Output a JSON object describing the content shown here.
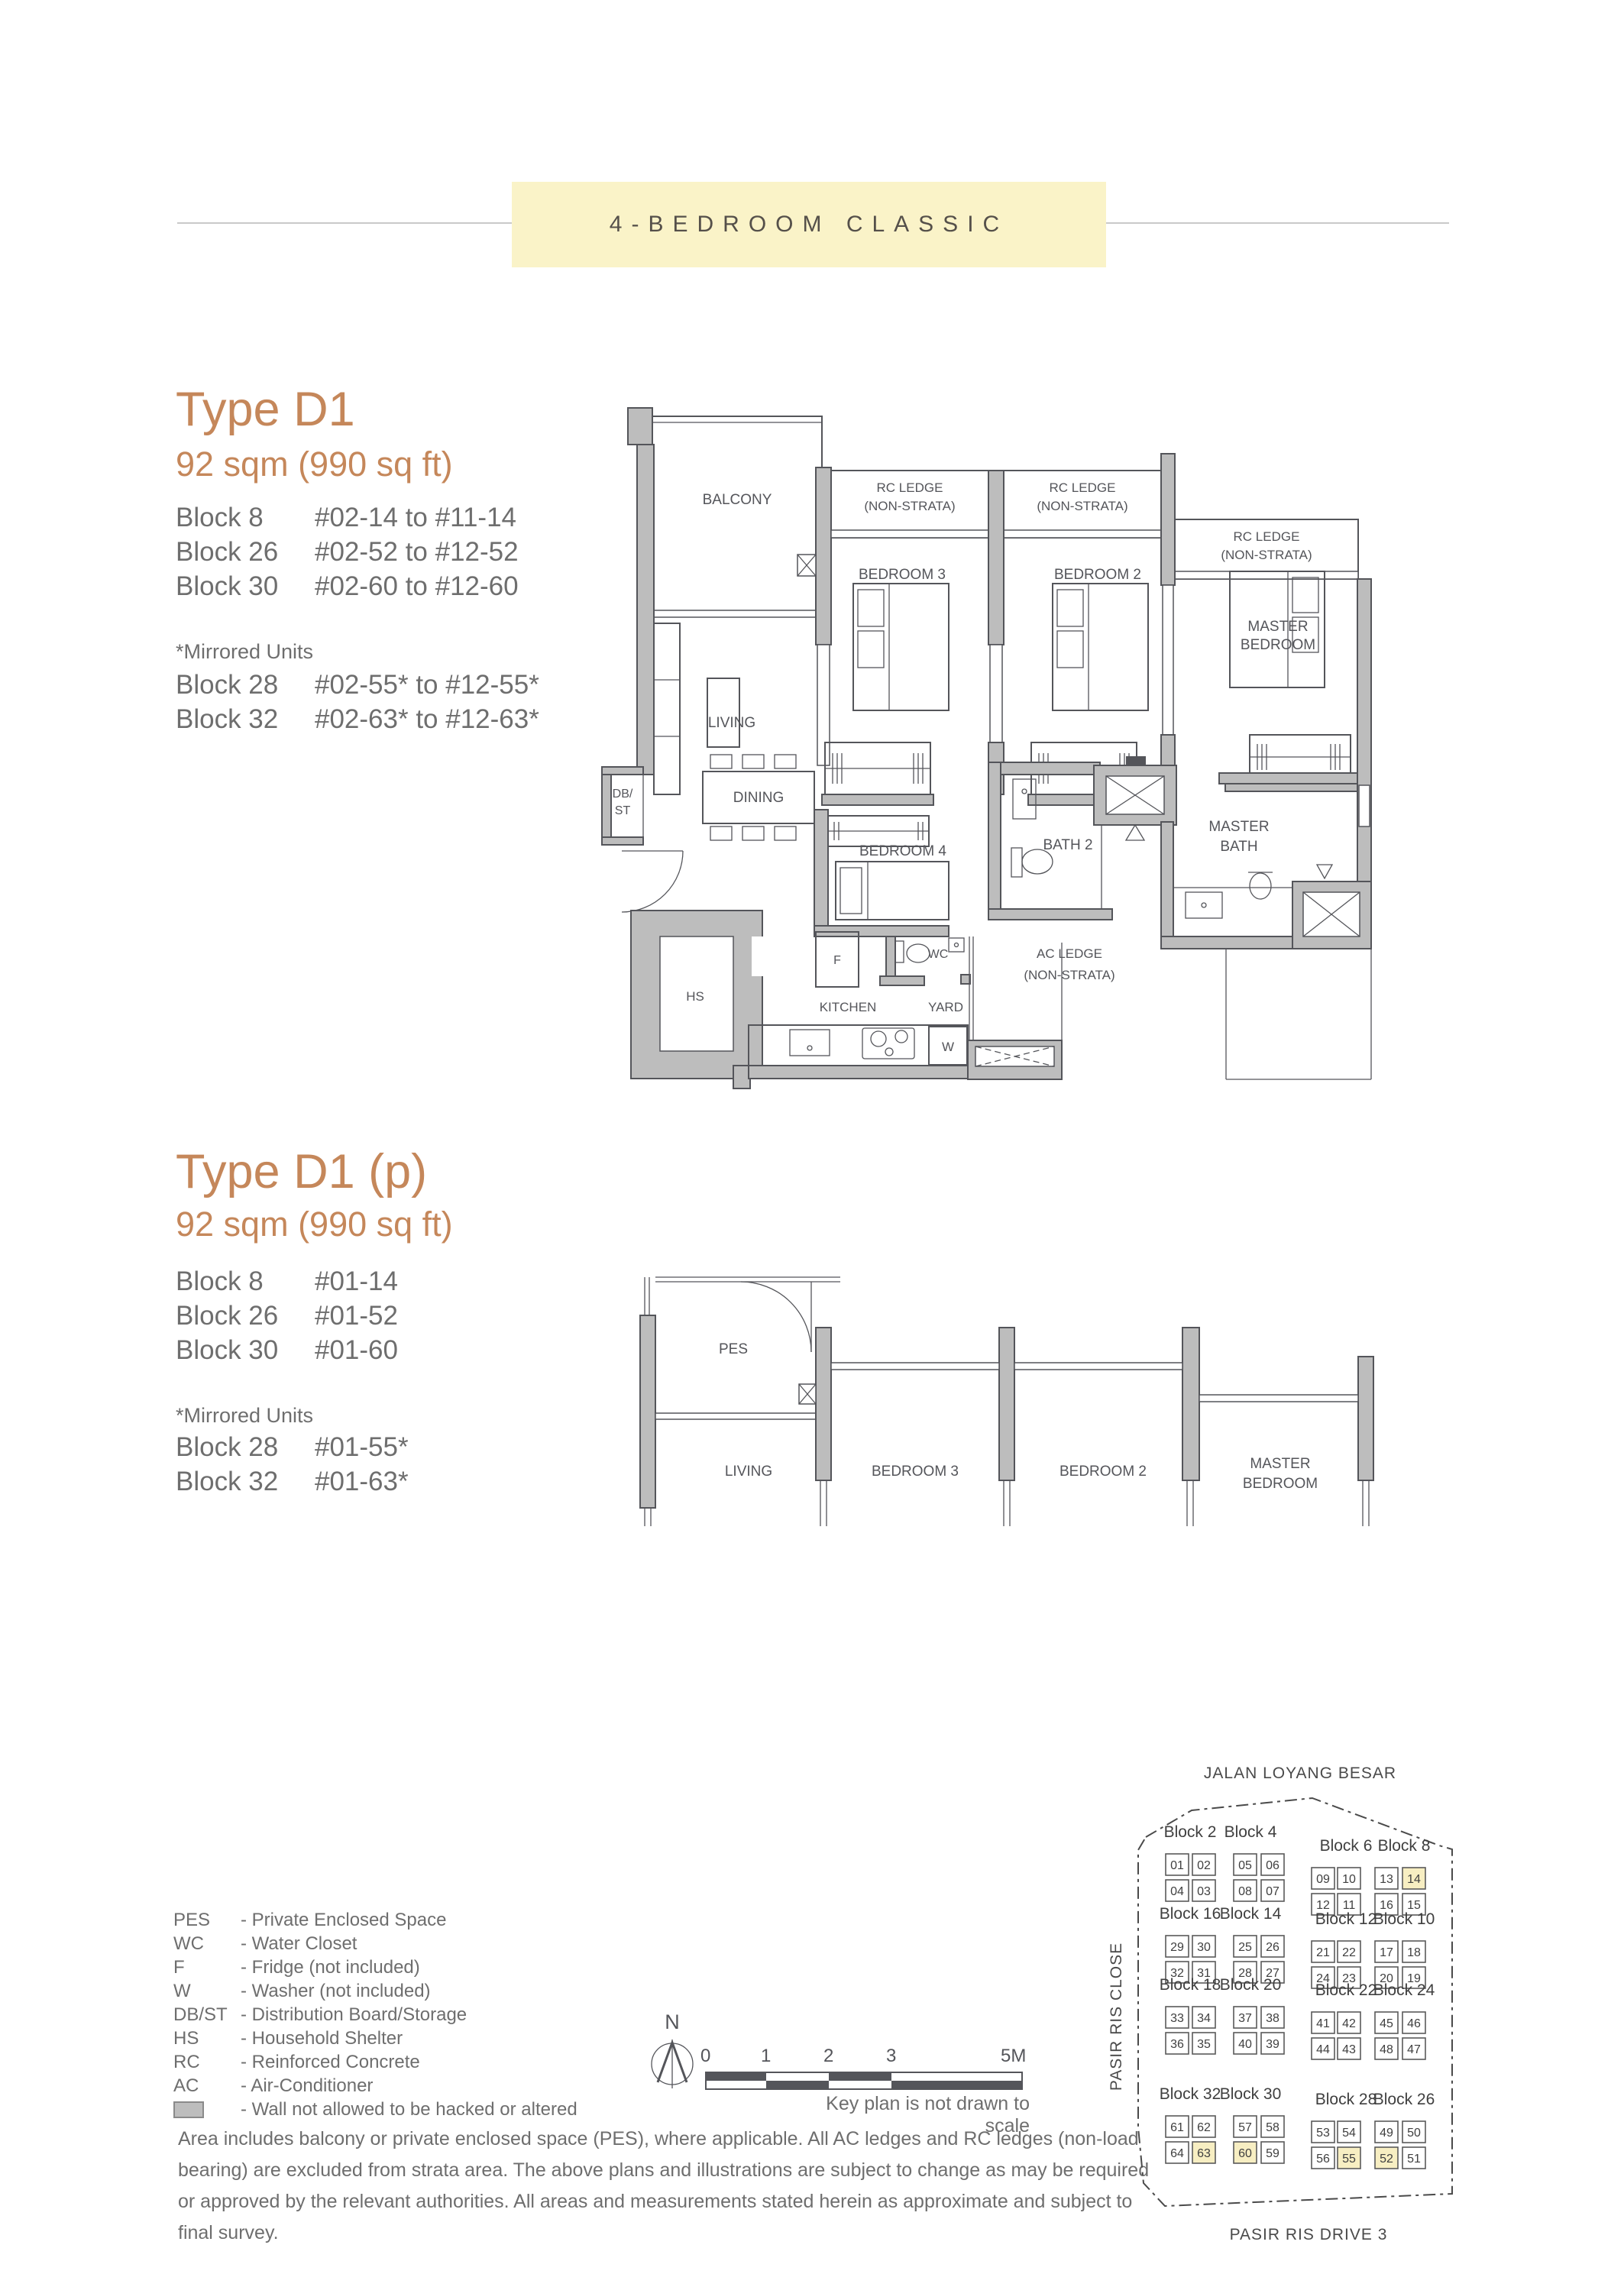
{
  "banner": {
    "label": "4-BEDROOM CLASSIC"
  },
  "type_d1": {
    "title": "Type D1",
    "area": "92 sqm (990 sq ft)",
    "blocks": [
      {
        "block": "Block 8",
        "units": "#02-14 to #11-14"
      },
      {
        "block": "Block 26",
        "units": "#02-52 to #12-52"
      },
      {
        "block": "Block 30",
        "units": "#02-60 to #12-60"
      }
    ],
    "mirrored_note": "*Mirrored Units",
    "mirrored_blocks": [
      {
        "block": "Block 28",
        "units": "#02-55* to #12-55*"
      },
      {
        "block": "Block 32",
        "units": "#02-63* to #12-63*"
      }
    ]
  },
  "type_d1p": {
    "title": "Type D1 (p)",
    "area": "92 sqm (990 sq ft)",
    "blocks": [
      {
        "block": "Block 8",
        "units": "#01-14"
      },
      {
        "block": "Block 26",
        "units": "#01-52"
      },
      {
        "block": "Block 30",
        "units": "#01-60"
      }
    ],
    "mirrored_note": "*Mirrored Units",
    "mirrored_blocks": [
      {
        "block": "Block 28",
        "units": "#01-55*"
      },
      {
        "block": "Block 32",
        "units": "#01-63*"
      }
    ]
  },
  "plan_labels": {
    "balcony": "BALCONY",
    "rc_ledge": "RC LEDGE",
    "non_strata": "(NON-STRATA)",
    "bedroom3": "BEDROOM 3",
    "bedroom2": "BEDROOM 2",
    "bedroom4": "BEDROOM 4",
    "master_line1": "MASTER",
    "master_line2": "BEDROOM",
    "master_bath_line2": "BATH",
    "living": "LIVING",
    "dining": "DINING",
    "bath2": "BATH 2",
    "ac_ledge": "AC LEDGE",
    "db_line1": "DB/",
    "db_line2": "ST",
    "fridge": "F",
    "wc": "WC",
    "hs": "HS",
    "kitchen": "KITCHEN",
    "yard": "YARD",
    "washer": "W",
    "pes": "PES"
  },
  "legend": {
    "items": [
      {
        "abbr": "PES",
        "desc": "- Private Enclosed Space"
      },
      {
        "abbr": "WC",
        "desc": "- Water Closet"
      },
      {
        "abbr": "F",
        "desc": "- Fridge (not included)"
      },
      {
        "abbr": "W",
        "desc": "- Washer (not included)"
      },
      {
        "abbr": "DB/ST",
        "desc": "- Distribution Board/Storage"
      },
      {
        "abbr": "HS",
        "desc": "- Household Shelter"
      },
      {
        "abbr": "RC",
        "desc": "- Reinforced Concrete"
      },
      {
        "abbr": "AC",
        "desc": "- Air-Conditioner"
      }
    ],
    "wall_swatch_desc": "- Wall not allowed to be hacked or altered"
  },
  "scalebar": {
    "north_label": "N",
    "ticks": [
      "0",
      "1",
      "2",
      "3",
      "5M"
    ],
    "note": "Key plan is not drawn to scale"
  },
  "disclaimer": {
    "text": "Area includes balcony or private enclosed space (PES), where applicable. All AC ledges and RC ledges (non-load bearing) are excluded from strata area. The above plans and illustrations are subject to change as may be required or approved by the relevant authorities. All areas and measurements stated herein as approximate and subject to final survey."
  },
  "keyplan": {
    "street_top": "JALAN LOYANG BESAR",
    "street_left": "PASIR RIS CLOSE",
    "street_bottom": "PASIR RIS DRIVE 3",
    "highlight_color": "#f7eec2",
    "groups": [
      {
        "labels": [
          "Block 2",
          "Block 4"
        ],
        "side": "left",
        "row": 0,
        "top": [
          "01",
          "02",
          "05",
          "06"
        ],
        "bottom": [
          "04",
          "03",
          "08",
          "07"
        ],
        "highlight": []
      },
      {
        "labels": [
          "Block 6",
          "Block 8"
        ],
        "side": "right",
        "row": 0,
        "top": [
          "09",
          "10",
          "13",
          "14"
        ],
        "bottom": [
          "12",
          "11",
          "16",
          "15"
        ],
        "highlight": [
          "14"
        ]
      },
      {
        "labels": [
          "Block 16",
          "Block 14"
        ],
        "side": "left",
        "row": 1,
        "top": [
          "29",
          "30",
          "25",
          "26"
        ],
        "bottom": [
          "32",
          "31",
          "28",
          "27"
        ],
        "highlight": []
      },
      {
        "labels": [
          "Block 12",
          "Block 10"
        ],
        "side": "right",
        "row": 1,
        "top": [
          "21",
          "22",
          "17",
          "18"
        ],
        "bottom": [
          "24",
          "23",
          "20",
          "19"
        ],
        "highlight": []
      },
      {
        "labels": [
          "Block 18",
          "Block 20"
        ],
        "side": "left",
        "row": 2,
        "top": [
          "33",
          "34",
          "37",
          "38"
        ],
        "bottom": [
          "36",
          "35",
          "40",
          "39"
        ],
        "highlight": []
      },
      {
        "labels": [
          "Block 22",
          "Block 24"
        ],
        "side": "right",
        "row": 2,
        "top": [
          "41",
          "42",
          "45",
          "46"
        ],
        "bottom": [
          "44",
          "43",
          "48",
          "47"
        ],
        "highlight": []
      },
      {
        "labels": [
          "Block 32",
          "Block 30"
        ],
        "side": "left",
        "row": 3,
        "top": [
          "61",
          "62",
          "57",
          "58"
        ],
        "bottom": [
          "64",
          "63",
          "60",
          "59"
        ],
        "highlight": [
          "63",
          "60"
        ]
      },
      {
        "labels": [
          "Block 28",
          "Block 26"
        ],
        "side": "right",
        "row": 3,
        "top": [
          "53",
          "54",
          "49",
          "50"
        ],
        "bottom": [
          "56",
          "55",
          "52",
          "51"
        ],
        "highlight": [
          "55",
          "52"
        ]
      }
    ]
  },
  "colors": {
    "accent_orange": "#c5875a",
    "banner_bg": "#faf3c8",
    "wall_gray": "#bdbdbd",
    "line_dark": "#54555a",
    "text_gray": "#6e6e6e",
    "highlight_yellow": "#f7eec2"
  }
}
